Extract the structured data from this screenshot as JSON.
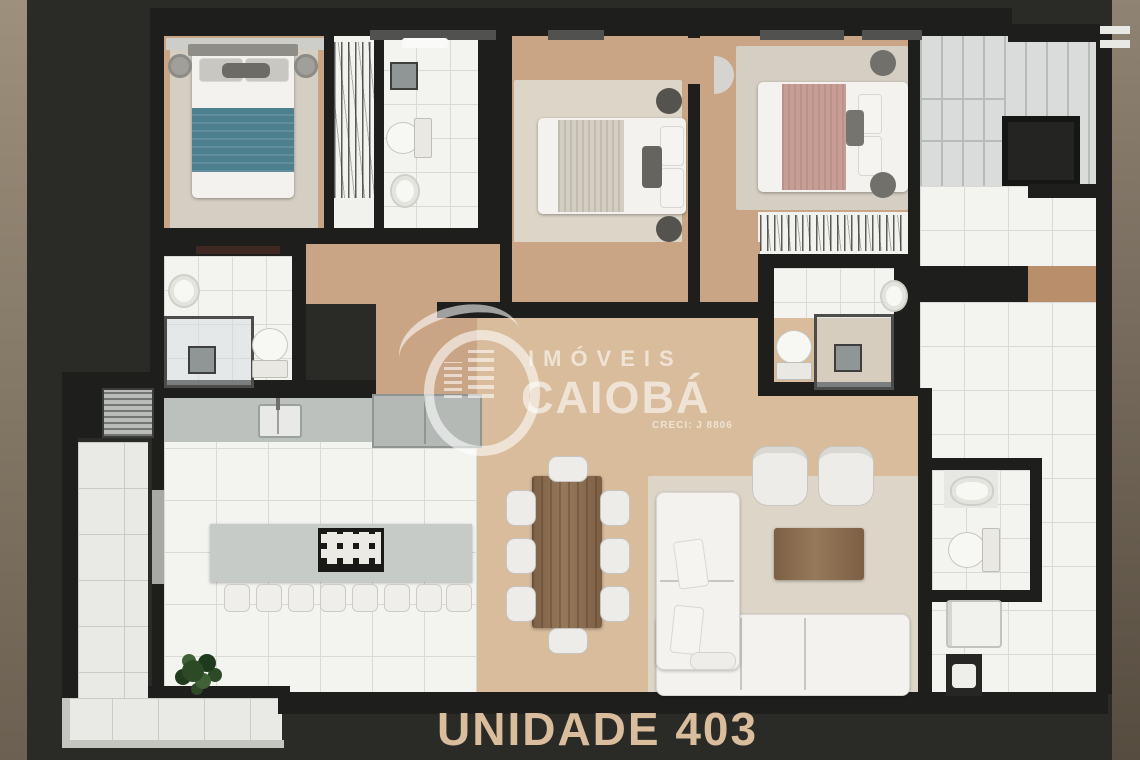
{
  "watermark": {
    "brand_top": "IMÓVEIS",
    "brand_bottom": "CAIOBÁ",
    "license": "CRECI: J 8806"
  },
  "caption": {
    "text": "UNIDADE 403"
  },
  "colors": {
    "bg": "#2a2a27",
    "stripLeftTop": "#9d907c",
    "stripLeftBottom": "#6b6051",
    "stripRightTop": "#8f8373",
    "stripRightBottom": "#564c3f",
    "wall": "#1e1e1c",
    "wood": "#c9a585",
    "woodLight": "#d8bc9c",
    "woodDark": "#b98f6b",
    "rug": "#d5cfc3",
    "rugLight": "#ddd6c8",
    "tile": "#f3f3f0",
    "grout": "#d9d9d5",
    "balconyTile": "#e9e9e5",
    "balconyGrout": "#cbcbc6",
    "counter": "#bcc1be",
    "cabinet": "#b4b9b6",
    "island": "#c6cbc8",
    "stair": "#d9dcda",
    "stairLine": "#b7bbb9",
    "shaft": "#242422",
    "white": "#f3f2ee",
    "teal": "#4d808f",
    "pink": "#c79e96",
    "bedgray": "#d3cec1",
    "darkgray": "#55534e",
    "midgray": "#8f8d88",
    "brown": "#7d5f45",
    "console": "#3f2822",
    "fixture": "#8f9695",
    "plant": "#2c4a26",
    "windowGray": "#51514f",
    "watermark": "rgba(255,255,255,0.58)",
    "caption": "#d9bd9c"
  }
}
